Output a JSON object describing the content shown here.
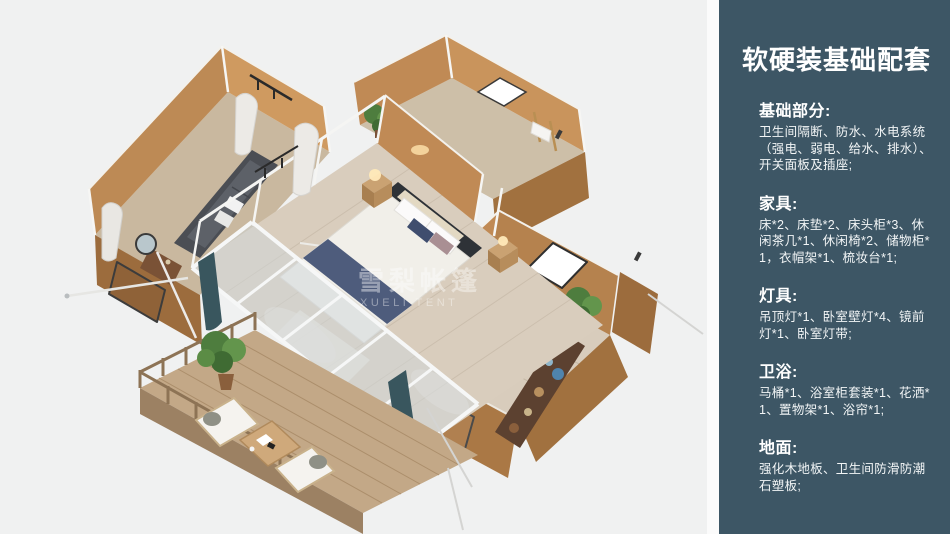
{
  "colors": {
    "panel-bg": "#3d5665",
    "panel-text": "#f2f5f6",
    "canvas-bg": "#f0f1f1",
    "gutter": "#fbfbfb",
    "tent-wall": "#c08a55",
    "tent-wall-shade": "#9c6c3d",
    "wood-floor": "#d9cdbd",
    "deck-wood": "#c3a887",
    "accent-navy": "#4e5c7c",
    "plant-green": "#4e7d3e"
  },
  "panel": {
    "title": "软硬装基础配套",
    "sections": [
      {
        "heading": "基础部分:",
        "body": "卫生间隔断、防水、水电系统（强电、弱电、给水、排水）、开关面板及插座;"
      },
      {
        "heading": "家具:",
        "body": "床*2、床垫*2、床头柜*3、休闲茶几*1、休闲椅*2、储物柜*1，衣帽架*1、梳妆台*1;"
      },
      {
        "heading": "灯具:",
        "body": "吊顶灯*1、卧室壁灯*4、镜前灯*1、卧室灯带;"
      },
      {
        "heading": "卫浴:",
        "body": "马桶*1、浴室柜套装*1、花洒*1、置物架*1、浴帘*1;"
      },
      {
        "heading": "地面:",
        "body": "强化木地板、卫生间防滑防潮石塑板;"
      }
    ]
  },
  "illustration": {
    "watermark": "雪梨帐篷",
    "watermark_sub": "XUELI TENT"
  }
}
